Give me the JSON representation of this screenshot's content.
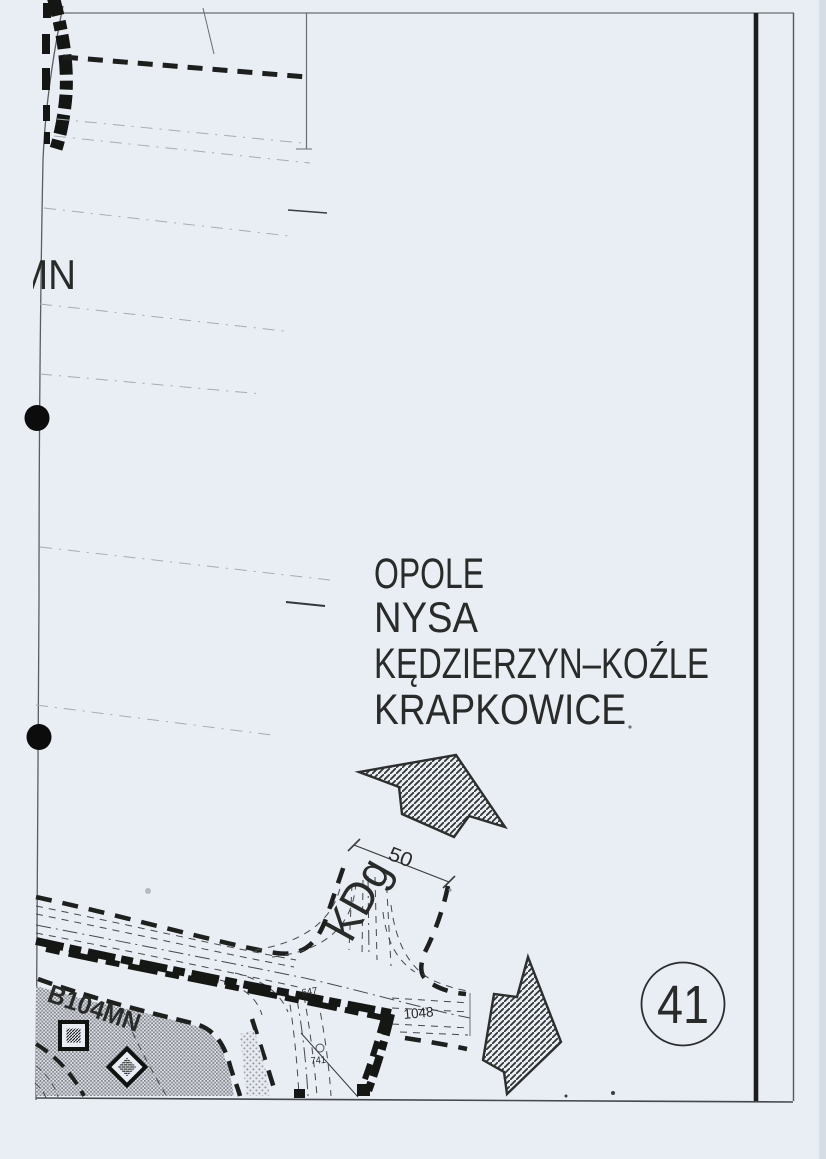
{
  "sheet": {
    "number": "41",
    "description": "scanned zoning plan sheet fragment"
  },
  "sign": {
    "cities": [
      "OPOLE",
      "NYSA",
      "KĘDZIERZYN–KOŹLE",
      "KRAPKOWICE"
    ]
  },
  "roads": {
    "class_label": "KDg",
    "width_label": "50"
  },
  "zones": {
    "edge_label": "MN",
    "block_label": "B104MN"
  },
  "parcels": {
    "p1048": "1048",
    "p647": "647",
    "p741": "741"
  },
  "colors": {
    "paper": "#e9edf4",
    "ink": "#2a2d2a",
    "ink_heavy": "#141614",
    "faint_line": "#a6abb2",
    "stipple": "#85898f"
  }
}
